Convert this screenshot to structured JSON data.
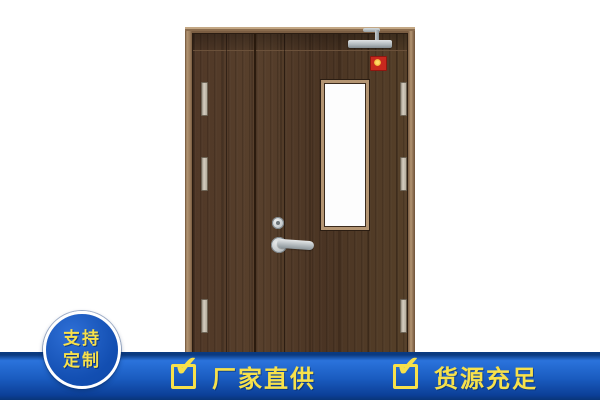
{
  "badge": {
    "lines": [
      "支持",
      "定制"
    ],
    "bg_color": "#134fb2",
    "text_color": "#f7e14b"
  },
  "banner": {
    "features": [
      {
        "icon": "checkbox-checked-icon",
        "label": "厂家直供"
      },
      {
        "icon": "checkbox-checked-icon",
        "label": "货源充足"
      }
    ],
    "bg_color_main": "#1a5cc0",
    "bg_color_dark": "#0c3f97",
    "text_color": "#f7e14b"
  },
  "icons": {
    "check": "✔"
  },
  "product_image": {
    "description": "dark walnut double-leaf fire door with vertical vision glass, door closer, red fire label, lever handle and hinges",
    "wood_color": "#4e3726",
    "frame_color": "#9a7c5c",
    "label_color": "#c8281e"
  }
}
